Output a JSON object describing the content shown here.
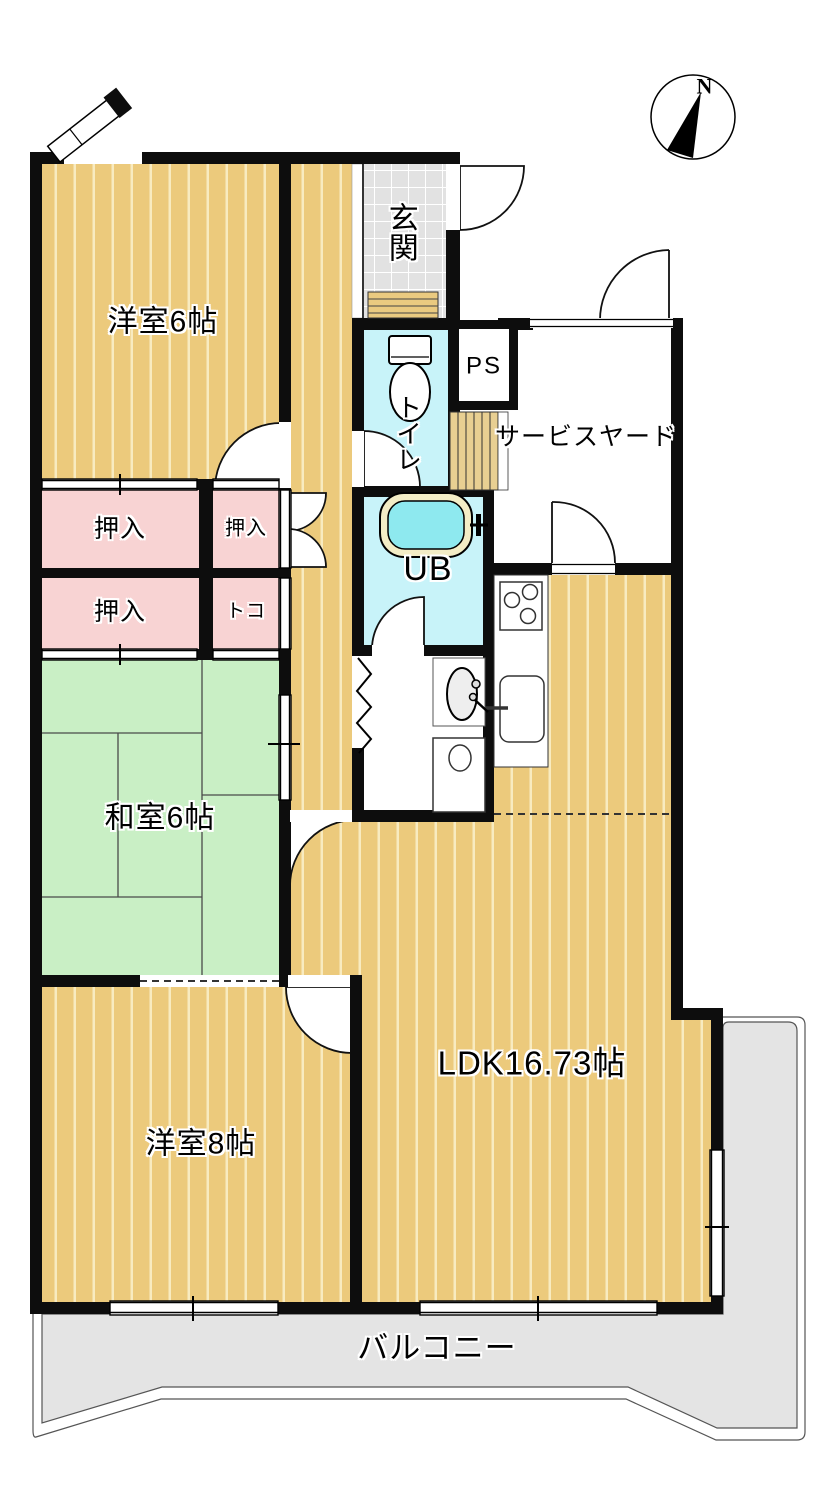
{
  "compass": {
    "north_label": "N"
  },
  "rooms": {
    "western_room_6": {
      "label": "洋室6帖"
    },
    "entrance": {
      "label": "玄関"
    },
    "pipe_space": {
      "label": "PS"
    },
    "service_yard": {
      "label": "サービスヤード"
    },
    "toilet": {
      "label": "トイレ"
    },
    "unit_bath": {
      "label": "UB"
    },
    "closet_upper_left": {
      "label": "押入"
    },
    "closet_upper_right": {
      "label": "押入"
    },
    "closet_lower_left": {
      "label": "押入"
    },
    "tokonoma": {
      "label": "トコ"
    },
    "japanese_room_6": {
      "label": "和室6帖"
    },
    "ldk": {
      "label": "LDK16.73帖"
    },
    "western_room_8": {
      "label": "洋室8帖"
    },
    "balcony": {
      "label": "バルコニー"
    }
  },
  "colors": {
    "wall": "#0d0d0d",
    "wood_floor": "#ecca7c",
    "wood_stripe": "#f8ebc0",
    "tatami_green": "#c9efc5",
    "closet_pink": "#f8d3d3",
    "entrance_tile": "#e2e2e2",
    "bathroom_cyan": "#c8f3f9",
    "bath_water": "#8ee9ef",
    "balcony_gray": "#e4e4e4"
  }
}
